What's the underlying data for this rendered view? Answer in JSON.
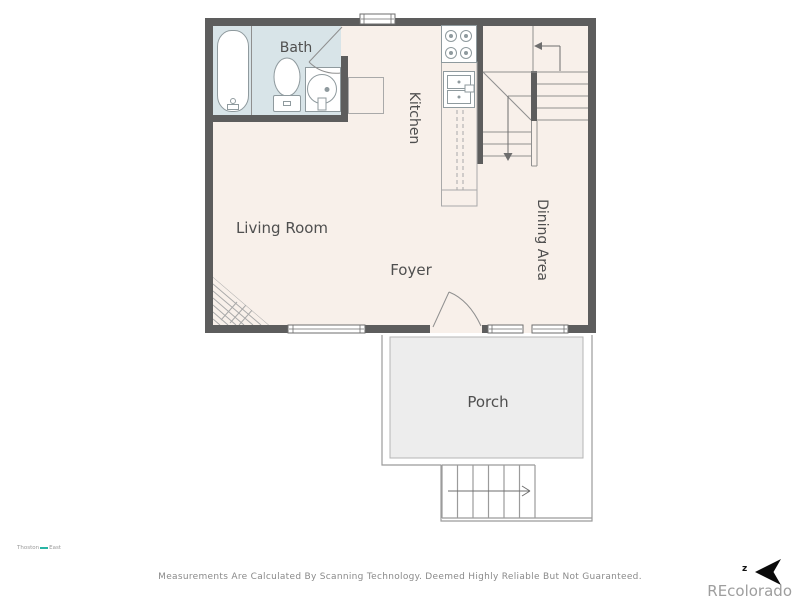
{
  "plan": {
    "rooms": {
      "bath": "Bath",
      "kitchen": "Kitchen",
      "living_room": "Living Room",
      "foyer": "Foyer",
      "dining_area": "Dining Area",
      "porch": "Porch"
    }
  },
  "footer": {
    "disclaimer": "Measurements Are Calculated By Scanning Technology. Deemed Highly Reliable But Not Guaranteed."
  },
  "branding": {
    "logo_left": "Thoston",
    "logo_right": "East",
    "compass_letter": "z",
    "watermark": "REcolorado"
  },
  "colors": {
    "wall": "#5d5d5d",
    "floor": "#f8f0ea",
    "bath_floor": "#d8e4e8",
    "porch": "#ededed",
    "line": "#8f8f8f",
    "label": "#4f4f4f",
    "watermark_text": "#9e9e9e",
    "compass": "#000000",
    "logo_accent": "#2ab5a5"
  }
}
